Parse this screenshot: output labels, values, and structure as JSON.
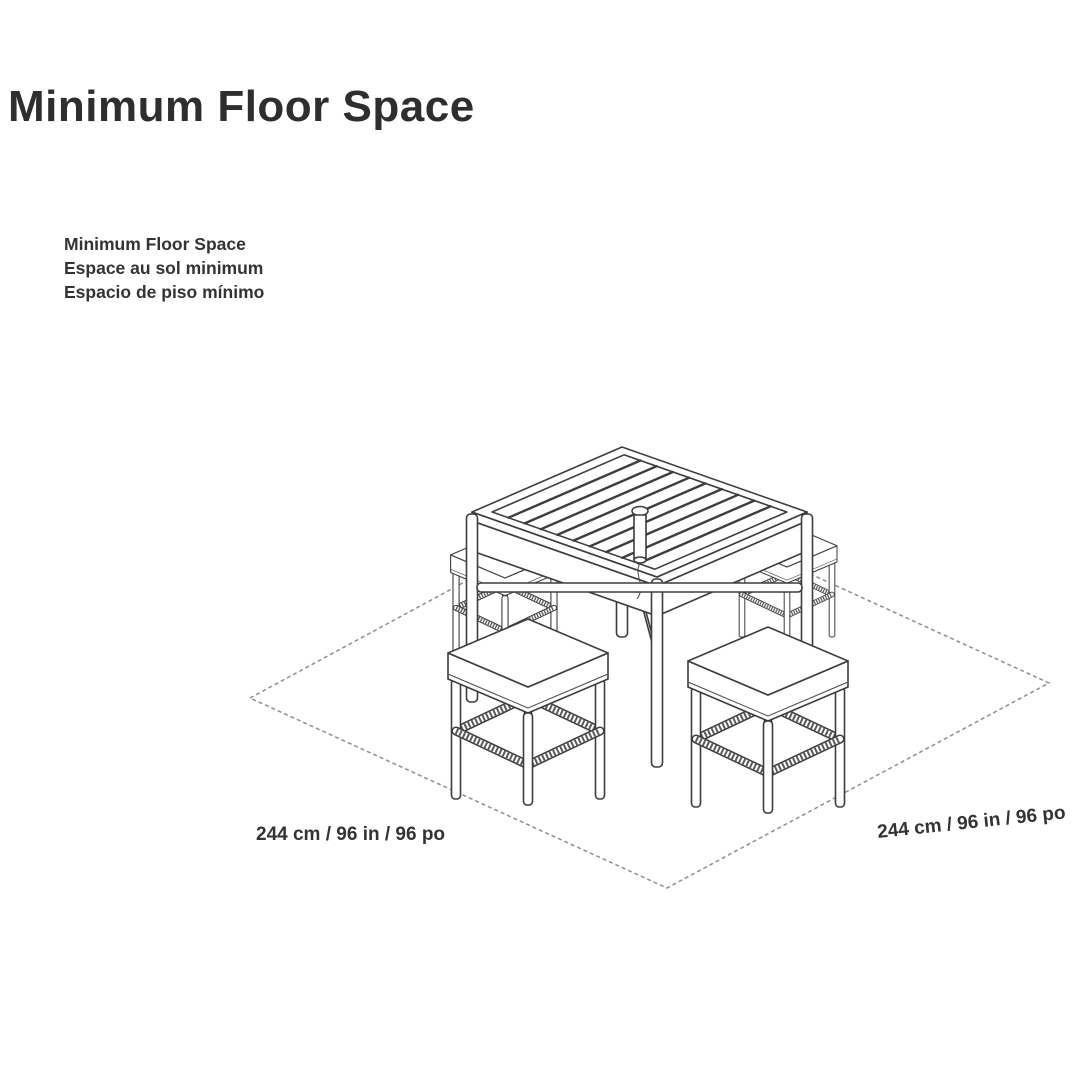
{
  "page": {
    "background": "#ffffff"
  },
  "title": "Minimum Floor Space",
  "label_block": {
    "line_en": "Minimum Floor Space",
    "line_fr": "Espace au sol minimum",
    "line_es": "Espacio de piso mínimo"
  },
  "diagram": {
    "type": "isometric-floor-space-diagram",
    "floor": {
      "left_dimension_label": "244 cm / 96 in / 96 po",
      "right_dimension_label": "244 cm / 96 in / 96 po",
      "outline_style": "dashed",
      "outline_color": "#8f8f8f"
    },
    "furniture": {
      "table": "square bar table with slatted top and center umbrella hole",
      "stools": "four backless bar stools with woven stretcher rails"
    },
    "line_color": "#3d3d3d"
  }
}
